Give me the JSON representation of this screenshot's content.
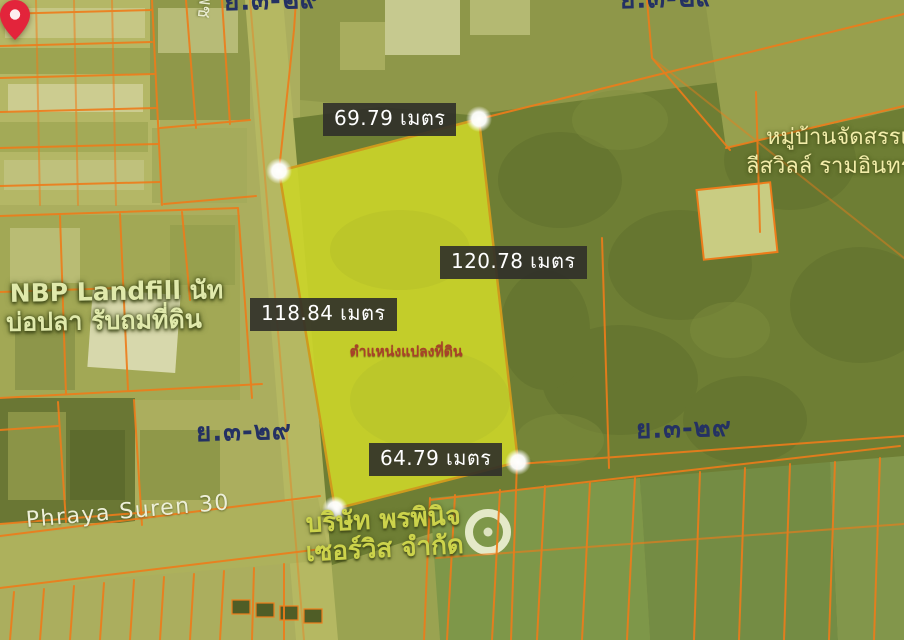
{
  "measurements": {
    "top": "69.79 เมตร",
    "right": "120.78 เมตร",
    "left": "118.84 เมตร",
    "bottom": "64.79 เมตร"
  },
  "pin": {
    "label": "ตำแหน่งแปลงที่ดิน"
  },
  "labels": {
    "nbp_line1": "NBP Landfill นัท",
    "nbp_line2": "บ่อปลา รับถมที่ดิน",
    "village_line1": "หมู่บ้านจัดสรรเ",
    "village_line2": "ลีสวิลล์ รามอินทรา.",
    "company_line1": "บริษัท พรพินิจ",
    "company_line2": "เซอร์วิส จำกัด",
    "road_phraya": "Phraya Suren 30",
    "road_vertical": "เพช",
    "zoning": "ย.๓-๒๙"
  },
  "colors": {
    "plot_fill": "#c9d32a",
    "plot_stroke": "#cf9a1d",
    "parcel_line": "#ee7c1a",
    "pin_color": "#e3243b",
    "pin_text": "#a8402a",
    "zoning_text": "#243163",
    "label_bg": "#2f2f29",
    "map_base": "#9aa351"
  }
}
